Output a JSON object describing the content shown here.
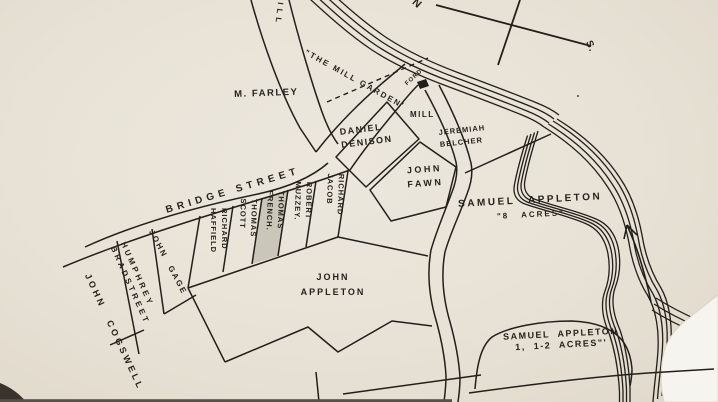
{
  "compass": {
    "north": "N",
    "south": "S."
  },
  "river": {
    "mill_garden": "\"THE MILL GARDEN'",
    "ford": "FORD",
    "mill": "MILL"
  },
  "streets": {
    "bridge": "BRIDGE STREET",
    "mill_road_partial": "ILL"
  },
  "lots": {
    "farley": "M. FARLEY",
    "denison": [
      "DANIEL",
      "DENISON"
    ],
    "belcher": [
      "JEREMIAH",
      "BELCHER"
    ],
    "fawn": [
      "JOHN",
      "FAWN"
    ],
    "jacob": [
      "RICHARD",
      "JACOB"
    ],
    "muzzey": [
      "ROBERT",
      "MUZZEY."
    ],
    "french": [
      "THOMAS",
      "FRENCH."
    ],
    "scott": [
      "THOMAS",
      "SCOTT"
    ],
    "haffield": [
      "RICHARD",
      "HAFFIELD"
    ],
    "gage": "JOHN GAGE",
    "bradstreet": [
      "HUMPHREY",
      "BRADSTREET"
    ],
    "cogswell": "JOHN COGSWELL",
    "john_appleton": [
      "JOHN",
      "APPLETON"
    ],
    "samuel_appleton_8": [
      "SAMUEL APPLETON",
      "\"8 ACRES\""
    ],
    "samuel_appleton_1_2": [
      "SAMUEL APPLETON",
      "1, 1-2 ACRES\"'"
    ]
  },
  "colors": {
    "paper": "#e9e3d8",
    "ink": "#221f1b",
    "french_lot_fill": "#cbc6ba",
    "page_corner": "#f6f4ee"
  }
}
